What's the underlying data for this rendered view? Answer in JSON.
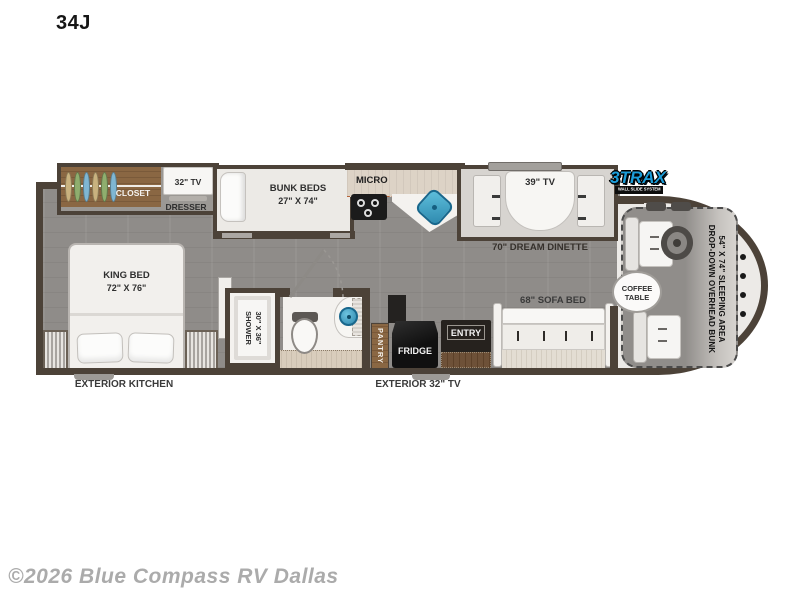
{
  "title": "34J",
  "watermark": "©2026 Blue Compass RV Dallas",
  "logo": {
    "brand": "3TRAX",
    "tagline": "WALL SLIDE SYSTEM"
  },
  "colors": {
    "wall": "#4c4238",
    "floor": "#8f8c89",
    "wood": "#8a6743",
    "counter": "#ddd3c6",
    "sink_teal": "#3ba3c9",
    "appliance_black": "#161616",
    "logo_blue": "#1b9cd8",
    "label_text": "#2e2e2e",
    "watermark_gray": "#ababab"
  },
  "bedroom": {
    "closet": "CLOSET",
    "tv": "32\" TV",
    "dresser": "DRESSER",
    "bed": "KING BED",
    "bed_size": "72\" X 76\"",
    "exterior_kitchen": "EXTERIOR KITCHEN"
  },
  "bunk": {
    "name": "BUNK BEDS",
    "size": "27\" X 74\""
  },
  "bath": {
    "shower": "SHOWER",
    "shower_size": "30\" X 36\""
  },
  "kitchen": {
    "micro": "MICRO",
    "pantry": "PANTRY",
    "fridge": "FRIDGE",
    "entry": "ENTRY",
    "exterior_tv": "EXTERIOR 32\" TV"
  },
  "living": {
    "tv": "39\" TV",
    "dinette": "70\" DREAM DINETTE",
    "sofa": "68\" SOFA BED",
    "coffee_line1": "COFFEE",
    "coffee_line2": "TABLE"
  },
  "cab": {
    "bunk_line1": "DROP-DOWN OVERHEAD BUNK",
    "bunk_line2": "54\" X 74\" SLEEPING AREA"
  }
}
